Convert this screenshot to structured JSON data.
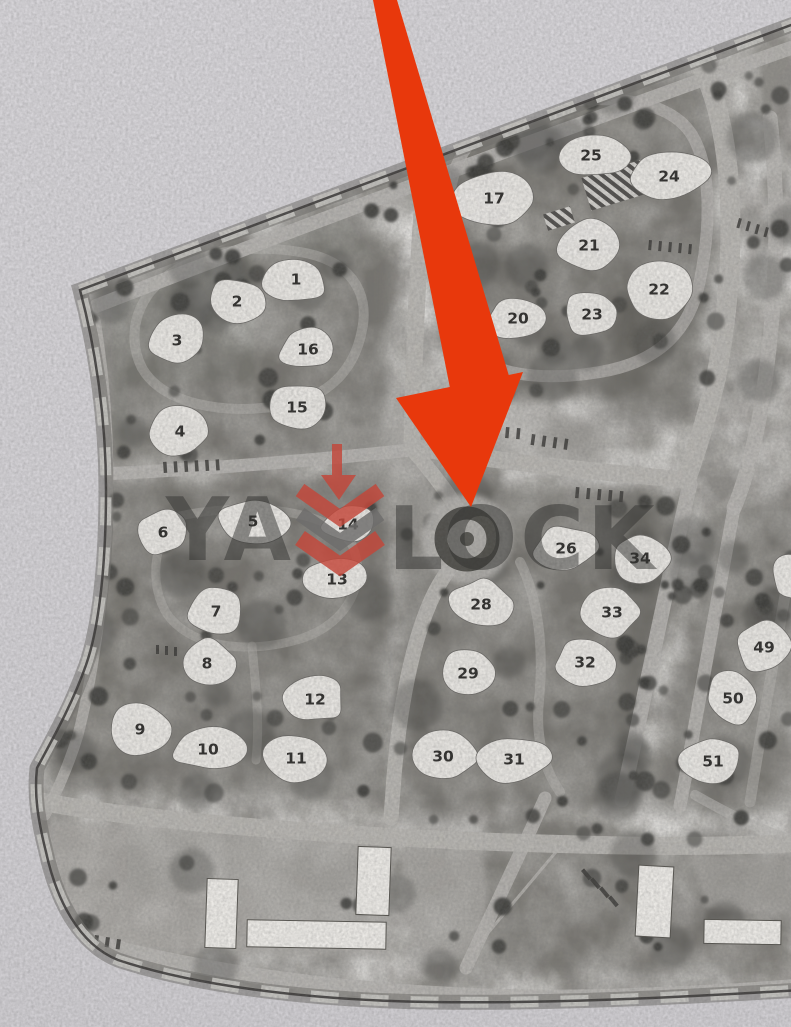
{
  "watermark": {
    "left": "YA",
    "right": "LOCK",
    "logo_red": "#c4473a",
    "logo_gray": "#6e6d6c"
  },
  "annotation": {
    "color": "#e8380c",
    "shaft": "373,0 397,0 509,376 450,388",
    "head": "396,398 523,372 471,507"
  },
  "map": {
    "colors": {
      "paper_top": "#d7d5d9",
      "paper_bottom": "#cfcdd1",
      "base": "#8d8b87",
      "road": "#b6b4b0",
      "dark": "#55534e",
      "tree": "#3b3a37",
      "lawn": "#a8a6a2",
      "plot": "#ebe9e5",
      "label": "#2e2d2b",
      "boundary": "#3c3a38",
      "stripe": "#c8c6c2",
      "band": "#716f6b",
      "hatch_dark": "#4a4846",
      "hatch_light": "#d9d7d3",
      "ring": "#45443f"
    },
    "outline": "M 80,290 Q 430,160 791,25 L 801,22 L 801,990 C 700,996 560,1004 430,1002 C 300,1000 190,984 118,960 C 78,944 56,898 46,852 C 38,820 34,795 37,768 C 52,740 72,705 86,665 C 100,625 106,560 106,490 C 106,420 96,350 80,290 Z",
    "roads": [
      {
        "d": "M 96,306 Q 442,172 791,48",
        "w": 14,
        "o": 0.9
      },
      {
        "d": "M 703,70 C 733,130 740,250 716,378 C 703,432 694,456 686,480",
        "w": 20,
        "o": 0.95
      },
      {
        "d": "M 770,118 C 781,220 776,320 759,420 C 749,468 741,492 734,508",
        "w": 15,
        "o": 0.85
      },
      {
        "d": "M 430,112 C 420,220 414,330 412,447",
        "w": 17,
        "o": 0.95
      },
      {
        "d": "M 412,447 C 500,462 600,472 686,480",
        "w": 17,
        "o": 0.95
      },
      {
        "d": "M 52,476 C 170,472 300,462 410,450",
        "w": 13,
        "o": 0.9
      },
      {
        "d": "M 95,320 C 108,400 110,470 106,540 C 102,610 92,680 78,735 C 68,768 55,795 45,815",
        "w": 11,
        "o": 0.8
      },
      {
        "d": "M 413,450 C 435,476 452,498 460,514",
        "w": 15,
        "o": 0.95
      },
      {
        "d": "M 454,564 C 420,600 400,690 393,790 L 391,818",
        "w": 15,
        "o": 0.95
      },
      {
        "d": "M 690,484 C 670,570 646,690 622,800",
        "w": 15,
        "o": 0.9
      },
      {
        "d": "M 734,508 C 720,590 700,700 680,806",
        "w": 13,
        "o": 0.85
      },
      {
        "d": "M 34,800 C 150,824 400,840 560,844 C 660,847 740,846 795,843",
        "w": 18,
        "o": 0.95
      },
      {
        "d": "M 545,798 C 520,855 492,912 466,968",
        "w": 13,
        "o": 0.85
      },
      {
        "d": "M 566,840 L 472,952",
        "w": 3,
        "o": 0.8
      },
      {
        "d": "M 60,932 C 200,978 420,1002 600,997 C 700,994 760,990 795,987",
        "w": 16,
        "o": 0.9
      },
      {
        "d": "M 695,795 C 725,812 756,828 791,840",
        "w": 10,
        "o": 0.6
      },
      {
        "d": "M 448,205 C 452,150 480,118 540,105 C 610,92 670,100 692,135 C 710,165 712,220 700,280 C 690,330 660,362 600,372 C 540,382 480,375 460,340 C 444,312 444,260 448,205 Z",
        "w": 12,
        "o": 0.7
      },
      {
        "d": "M 150,292 C 180,256 240,242 300,252 C 350,260 370,292 362,330 C 355,368 330,398 280,406 C 220,415 162,403 142,368 C 130,344 132,316 150,292 Z",
        "w": 10,
        "o": 0.5
      },
      {
        "d": "M 175,517 C 240,502 330,507 352,545 C 368,580 350,623 300,639 C 250,654 192,649 167,614 C 150,587 152,544 175,517 Z",
        "w": 9,
        "o": 0.45
      },
      {
        "d": "M 520,562 C 539,600 544,650 539,700 C 535,740 545,770 560,792",
        "w": 10,
        "o": 0.5
      },
      {
        "d": "M 252,646 C 256,690 260,722 256,760",
        "w": 9,
        "o": 0.45
      },
      {
        "d": "M 791,560 C 776,650 762,724 750,802",
        "w": 11,
        "o": 0.5
      }
    ],
    "zones": [
      {
        "d": "M 425,100 L 700,72 L 718,150 L 712,300 L 640,390 L 470,405 L 432,300 Z",
        "o": 0.45
      },
      {
        "d": "M 98,288 L 350,200 L 392,255 L 385,460 L 98,462 Z",
        "o": 0.42
      },
      {
        "d": "M 62,488 L 388,472 L 388,800 L 48,788 Z",
        "o": 0.45
      },
      {
        "d": "M 402,482 L 695,492 L 618,808 L 396,812 Z",
        "o": 0.45
      },
      {
        "d": "M 710,505 L 795,495 L 795,812 L 655,812 Z",
        "o": 0.42
      },
      {
        "d": "M 615,296 L 702,288 L 692,420 L 602,402 Z",
        "o": 0.5
      },
      {
        "d": "M 495,812 L 795,858 L 792,972 L 445,972 Z",
        "o": 0.38
      },
      {
        "d": "M 628,498 L 668,502 L 645,700 L 615,795 Z",
        "o": 0.5
      }
    ],
    "lawns": [
      {
        "d": "M 48,818 L 395,840 L 388,958 L 112,952 C 75,935 55,895 48,848 Z",
        "o": 0.75
      },
      {
        "d": "M 416,828 C 452,820 480,838 486,878 C 492,922 478,952 452,958 C 428,962 408,944 404,900 C 401,862 398,836 416,828 Z",
        "o": 0.8
      },
      {
        "d": "M 692,852 L 795,858 L 795,915 L 705,908 Z",
        "o": 0.7
      },
      {
        "d": "M 392,392 L 608,420 L 606,468 L 398,468 Z",
        "o": 0.55
      },
      {
        "d": "M 345,425 L 465,430 L 462,525 L 352,520 Z",
        "o": 0.4
      }
    ],
    "tree_zones": [
      {
        "x": 80,
        "y": 250,
        "w": 230,
        "h": 70,
        "n": 10
      },
      {
        "x": 290,
        "y": 168,
        "w": 220,
        "h": 70,
        "n": 10
      },
      {
        "x": 500,
        "y": 88,
        "w": 250,
        "h": 70,
        "n": 10
      },
      {
        "x": 430,
        "y": 95,
        "w": 285,
        "h": 300,
        "n": 26
      },
      {
        "x": 100,
        "y": 250,
        "w": 285,
        "h": 215,
        "n": 20
      },
      {
        "x": 65,
        "y": 490,
        "w": 320,
        "h": 305,
        "n": 30
      },
      {
        "x": 400,
        "y": 495,
        "w": 292,
        "h": 312,
        "n": 30
      },
      {
        "x": 618,
        "y": 498,
        "w": 92,
        "h": 300,
        "n": 14
      },
      {
        "x": 700,
        "y": 520,
        "w": 95,
        "h": 290,
        "n": 12
      },
      {
        "x": 50,
        "y": 815,
        "w": 735,
        "h": 158,
        "n": 26
      },
      {
        "x": 58,
        "y": 310,
        "w": 52,
        "h": 460,
        "n": 10
      },
      {
        "x": 700,
        "y": 58,
        "w": 90,
        "h": 340,
        "n": 14
      }
    ],
    "parking_rows": [
      [
        163,
        462,
        6,
        10.5,
        -0.5,
        3.5,
        11,
        -4
      ],
      [
        495,
        426,
        3,
        11,
        1,
        3.5,
        11,
        5
      ],
      [
        532,
        434,
        4,
        11,
        1.5,
        3.5,
        11,
        8
      ],
      [
        576,
        487,
        5,
        11,
        1,
        3.5,
        11,
        5
      ],
      [
        649,
        240,
        5,
        10,
        1,
        3,
        10,
        5
      ],
      [
        581,
        871,
        4,
        9,
        9,
        4,
        12,
        -40
      ],
      [
        84,
        933,
        4,
        11,
        2,
        4,
        10,
        8
      ],
      [
        156,
        645,
        3,
        9,
        1,
        3,
        9,
        0
      ],
      [
        739,
        218,
        4,
        9,
        3,
        3,
        10,
        15
      ]
    ],
    "roundabout": {
      "cx": 467,
      "cy": 539,
      "r_outer": 45,
      "r_ring": 26,
      "ring_w": 13,
      "r_center": 7
    },
    "courts": [
      {
        "x": 585,
        "y": 168,
        "w": 64,
        "h": 34,
        "rot": -17
      },
      {
        "x": 545,
        "y": 210,
        "w": 28,
        "h": 17,
        "rot": -17
      }
    ],
    "plots": [
      [
        "1",
        296,
        279,
        34,
        24
      ],
      [
        "2",
        237,
        301,
        33,
        24
      ],
      [
        "3",
        177,
        340,
        33,
        26
      ],
      [
        "16",
        308,
        349,
        31,
        22
      ],
      [
        "15",
        297,
        407,
        32,
        24
      ],
      [
        "4",
        180,
        431,
        33,
        25
      ],
      [
        "17",
        494,
        198,
        48,
        28
      ],
      [
        "25",
        591,
        155,
        40,
        24
      ],
      [
        "24",
        669,
        176,
        40,
        28
      ],
      [
        "21",
        589,
        245,
        34,
        26
      ],
      [
        "20",
        518,
        318,
        32,
        23
      ],
      [
        "23",
        592,
        314,
        32,
        23
      ],
      [
        "22",
        659,
        289,
        40,
        30
      ],
      [
        "6",
        163,
        532,
        30,
        24
      ],
      [
        "5",
        253,
        521,
        38,
        25
      ],
      [
        "14",
        348,
        524,
        28,
        21
      ],
      [
        "13",
        337,
        579,
        34,
        24
      ],
      [
        "7",
        216,
        611,
        31,
        26
      ],
      [
        "8",
        207,
        663,
        31,
        25
      ],
      [
        "9",
        140,
        729,
        31,
        26
      ],
      [
        "10",
        208,
        749,
        38,
        22
      ],
      [
        "12",
        315,
        699,
        31,
        25
      ],
      [
        "11",
        296,
        758,
        34,
        26
      ],
      [
        "26",
        566,
        548,
        34,
        24
      ],
      [
        "34",
        640,
        558,
        31,
        26
      ],
      [
        "28",
        481,
        604,
        34,
        26
      ],
      [
        "33",
        612,
        612,
        30,
        26
      ],
      [
        "32",
        585,
        662,
        31,
        26
      ],
      [
        "29",
        468,
        673,
        34,
        25
      ],
      [
        "30",
        443,
        756,
        35,
        26
      ],
      [
        "31",
        514,
        759,
        38,
        25
      ],
      [
        "49",
        764,
        647,
        30,
        27
      ],
      [
        "50",
        733,
        698,
        30,
        27
      ],
      [
        "51",
        713,
        761,
        32,
        27
      ],
      [
        "",
        797,
        575,
        28,
        24
      ]
    ],
    "buildings": [
      [
        206,
        879,
        31,
        69,
        2
      ],
      [
        247,
        921,
        139,
        27,
        1
      ],
      [
        357,
        847,
        33,
        68,
        2
      ],
      [
        637,
        866,
        35,
        71,
        3
      ],
      [
        704,
        920,
        77,
        24,
        1
      ]
    ]
  }
}
